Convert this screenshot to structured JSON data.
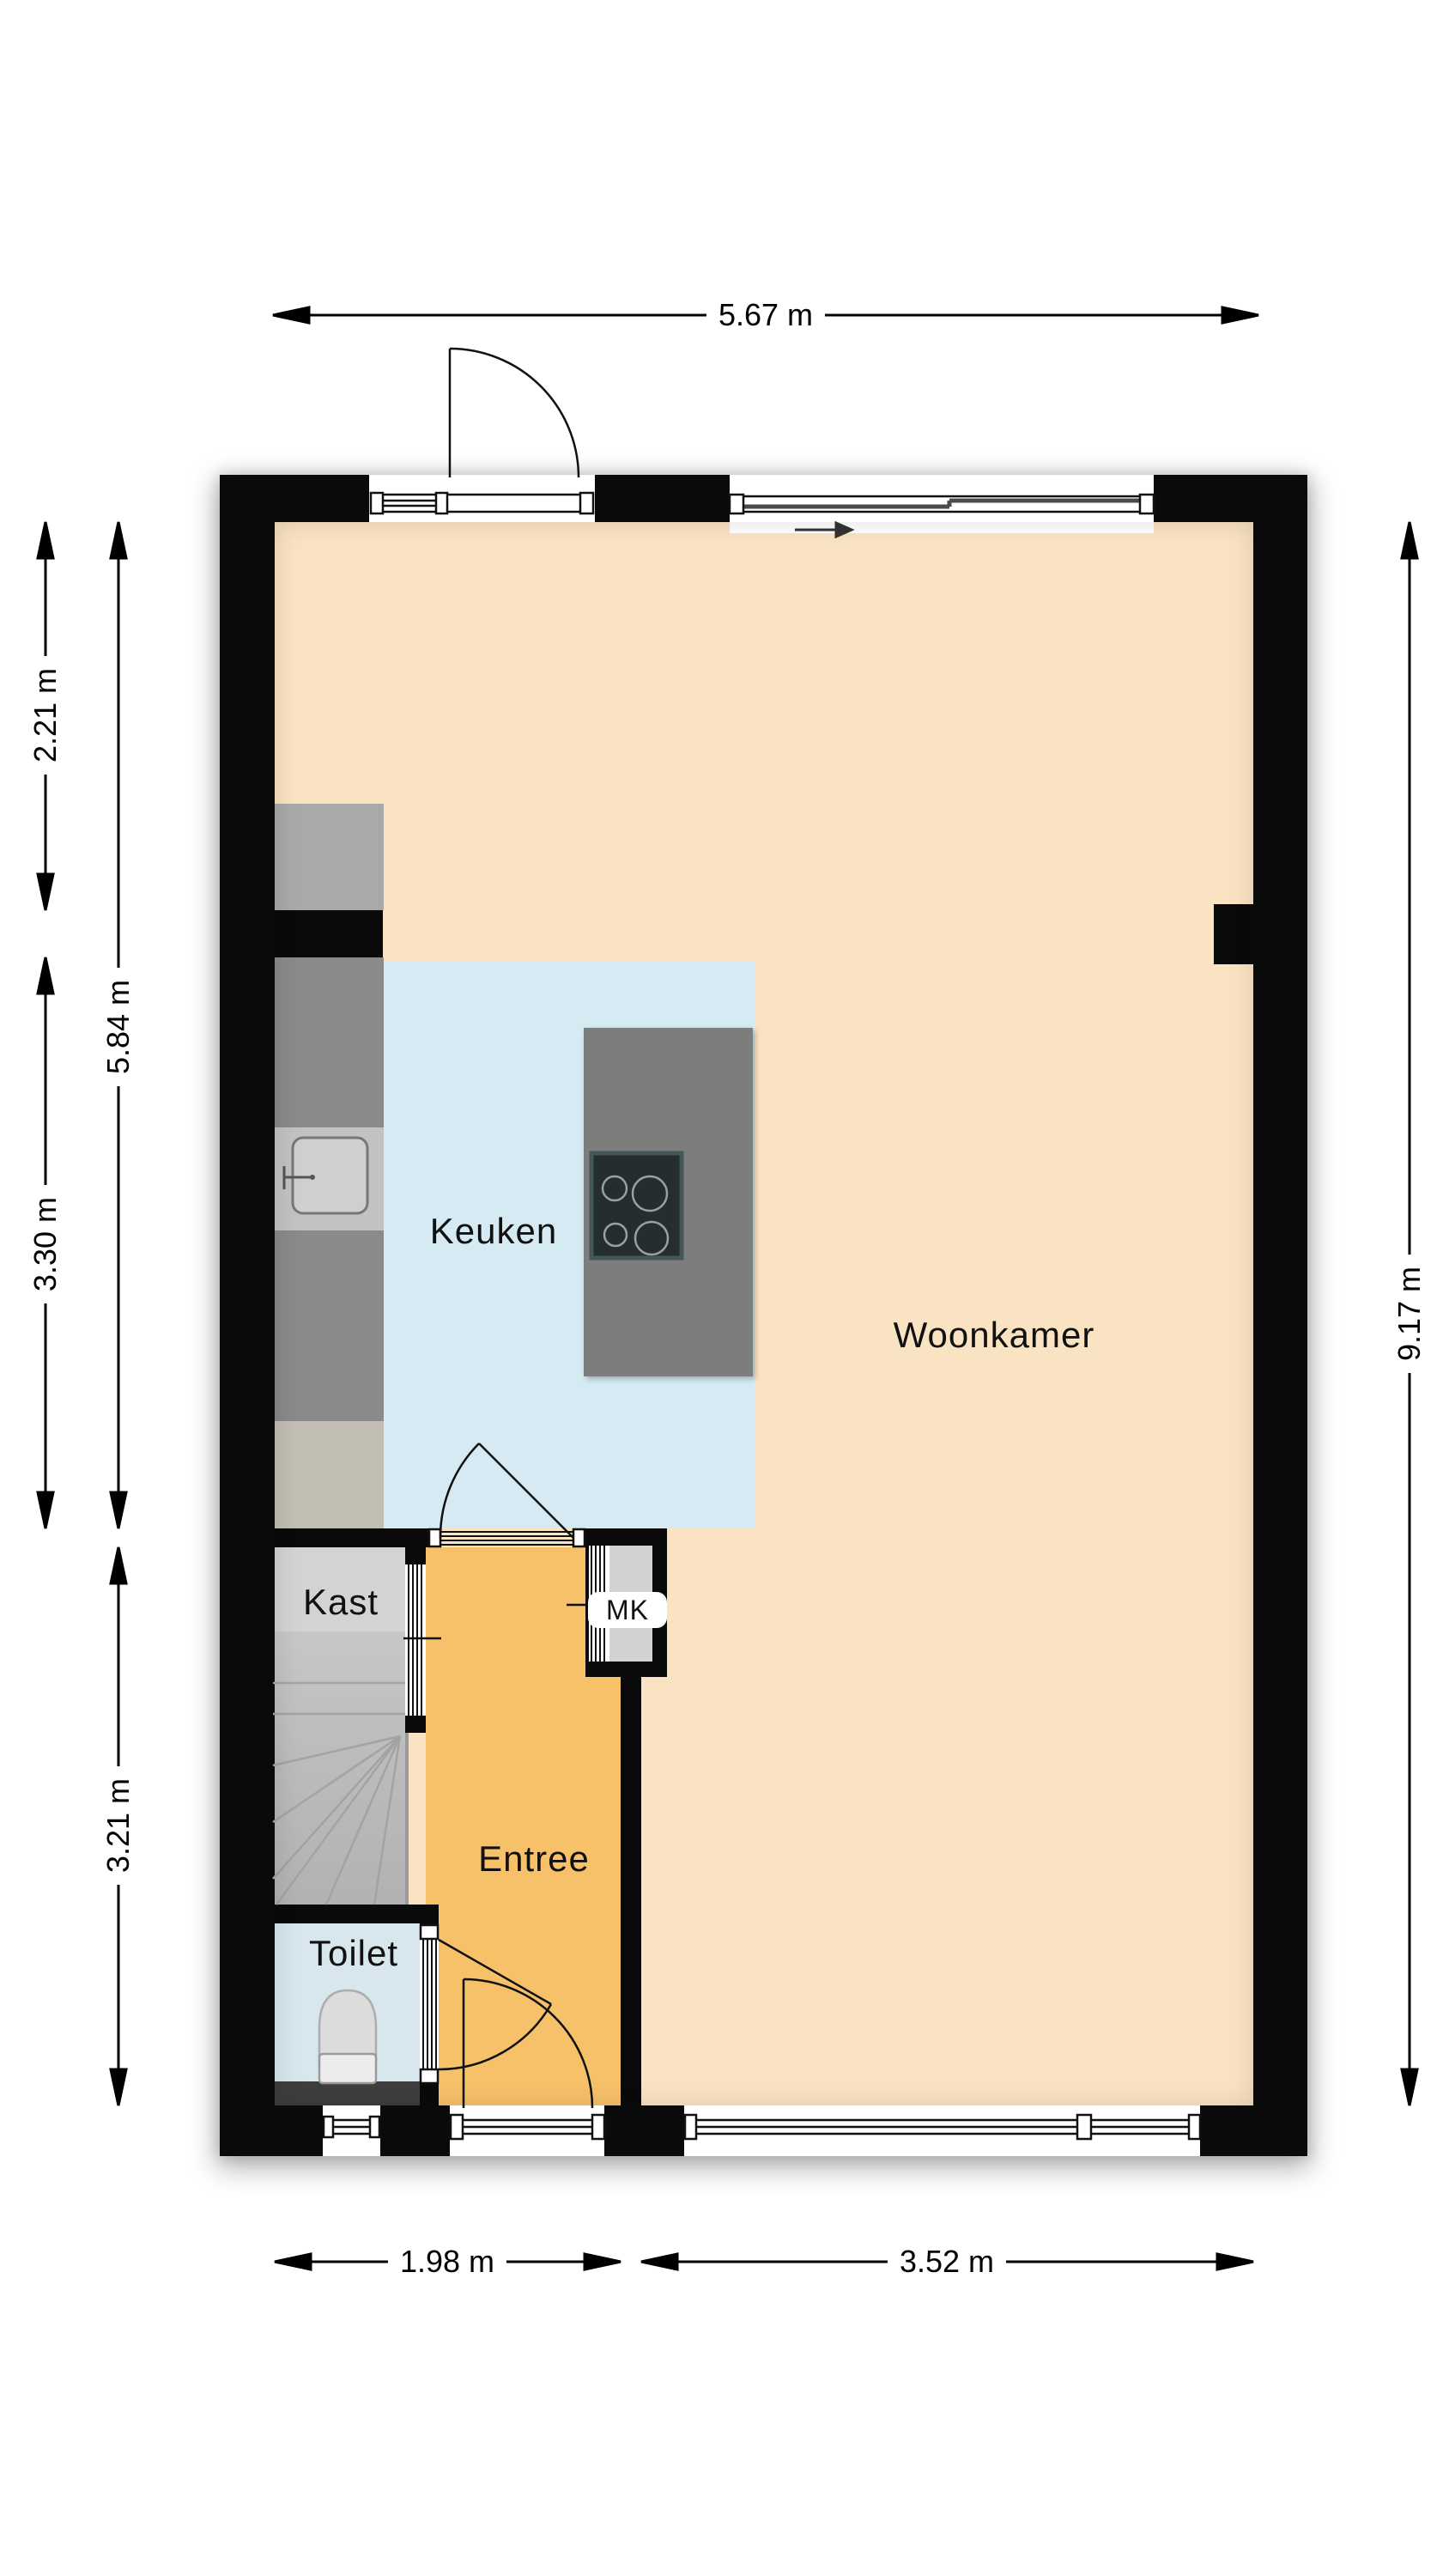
{
  "rooms": {
    "woonkamer": {
      "label": "Woonkamer"
    },
    "keuken": {
      "label": "Keuken"
    },
    "entree": {
      "label": "Entree"
    },
    "kast": {
      "label": "Kast"
    },
    "toilet": {
      "label": "Toilet"
    },
    "meterkast": {
      "label": "MK"
    }
  },
  "dimensions": {
    "top_width": "5.67 m",
    "left_upper_outer": "2.21 m",
    "left_lower_outer": "3.30 m",
    "left_full_inner": "5.84 m",
    "left_bottom_inner": "3.21 m",
    "right_height": "9.17 m",
    "bottom_left": "1.98 m",
    "bottom_right": "3.52 m"
  },
  "colors": {
    "wall": "#0a0a0a",
    "living_floor": "#fae3c2",
    "kitchen_floor": "#d5eaf2",
    "toilet_floor": "#d7e7ed",
    "entree_floor": "#f6c169",
    "counter_dark": "#8a8a8a",
    "cabinet_light": "#a9a9a9",
    "cabinet_taupe": "#c3beb3",
    "island_gray": "#7d7d7d",
    "cooktop_black": "#262d2e",
    "stairs_gray": "#bdbdbd",
    "landing_gray": "#d3d3d3",
    "mk_interior": "#d2d2d2",
    "toilet_band": "#3e3e3e"
  }
}
